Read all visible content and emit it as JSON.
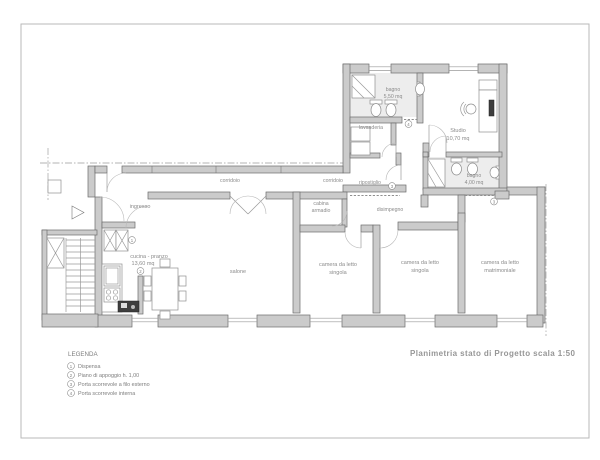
{
  "title": "Planimetria stato di Progetto scala 1:50",
  "legend": {
    "heading": "LEGENDA",
    "items": [
      {
        "num": "1",
        "label": "Dispensa"
      },
      {
        "num": "2",
        "label": "Piano di appoggio h. 1,00"
      },
      {
        "num": "3",
        "label": "Porta scorrevole a filo esterno"
      },
      {
        "num": "4",
        "label": "Porta scorrevole interna"
      }
    ]
  },
  "rooms": {
    "ingresso": {
      "name": "ingresso"
    },
    "cucina": {
      "name": "cucina - pranzo",
      "area": "13,60 mq"
    },
    "salone": {
      "name": "salone"
    },
    "corridoio1": {
      "name": "corridoio"
    },
    "corridoio2": {
      "name": "corridoio"
    },
    "cabina": {
      "line1": "cabina",
      "line2": "armadio"
    },
    "disimpegno": {
      "name": "disimpegno"
    },
    "camera1": {
      "line1": "camera da letto",
      "line2": "singola"
    },
    "camera2": {
      "line1": "camera da letto",
      "line2": "singola"
    },
    "matrimoniale": {
      "line1": "camera da letto",
      "line2": "matrimoniale"
    },
    "bagno1": {
      "name": "bagno",
      "area": "5,50 mq"
    },
    "lavanderia": {
      "name": "lavanderia"
    },
    "ripostiglio": {
      "name": "ripostiglio"
    },
    "studio": {
      "name": "Studio",
      "area": "10,70 mq"
    },
    "bagno2": {
      "name": "bagno",
      "area": "4,00 mq"
    }
  },
  "markers": {
    "m1": "1",
    "m2": "2",
    "m3a": "3",
    "m3b": "3",
    "m4": "4"
  },
  "colors": {
    "wall": "#cbcbcb",
    "wall_stroke": "#6b6b6b",
    "bath_floor": "#ededed",
    "label": "#8b8b8b",
    "title": "#969696"
  }
}
